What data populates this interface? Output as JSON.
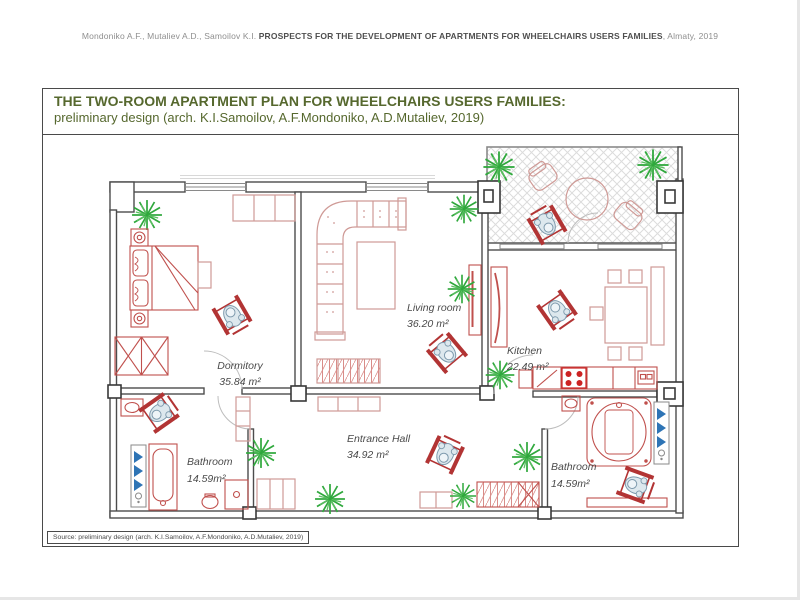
{
  "header": {
    "authors": "Mondoniko A.F., Mutaliev A.D., Samoilov K.I. ",
    "title": "PROSPECTS FOR THE DEVELOPMENT OF APARTMENTS FOR WHEELCHAIRS USERS FAMILIES",
    "tail": ", Almaty, 2019"
  },
  "panel": {
    "title": "THE TWO-ROOM APARTMENT PLAN FOR WHEELCHAIRS USERS FAMILIES:",
    "subtitle": "preliminary design (arch. K.I.Samoilov, A.F.Mondoniko, A.D.Mutaliev, 2019)",
    "source": "Source: preliminary design (arch. K.I.Samoilov, A.F.Mondoniko, A.D.Mutaliev, 2019)"
  },
  "plan": {
    "rooms": [
      {
        "name": "Dormitory",
        "area": "35.84 m²"
      },
      {
        "name": "Living room",
        "area": "36.20 m²"
      },
      {
        "name": "Kitchen",
        "area": "22.49 m²"
      },
      {
        "name": "Entrance Hall",
        "area": "34.92 m²"
      },
      {
        "name": "Bathroom",
        "area": "14.59m²"
      },
      {
        "name": "Bathroom",
        "area": "14.59m²"
      }
    ],
    "colors": {
      "title_green": "#56682e",
      "wall_gray": "#4c4c4c",
      "furniture_red": "#c0504d",
      "furniture_light_red": "#cf9a96",
      "stove_red": "#cc2222",
      "plant_green": "#2fa83c",
      "radiator_blue": "#2e74b5",
      "person_blue_gray": "#7e9aad"
    }
  }
}
